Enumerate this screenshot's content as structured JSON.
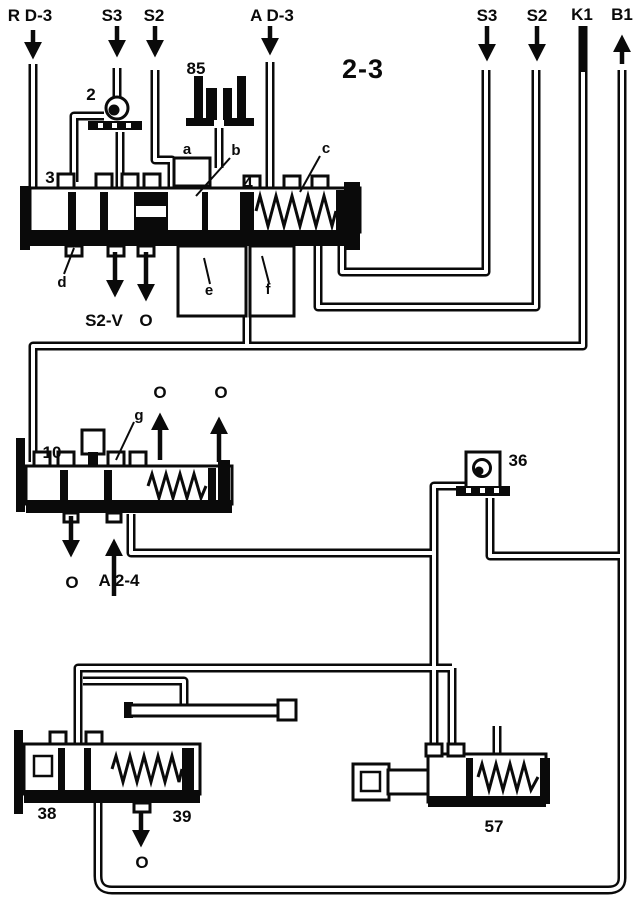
{
  "title": "2-3",
  "top_ports": {
    "rd3": "R D-3",
    "s3_left": "S3",
    "s2_left": "S2",
    "ad3": "A D-3",
    "s3_right": "S3",
    "s2_right": "S2",
    "k1": "K1",
    "b1": "B1"
  },
  "part_numbers": {
    "check_valve_upper": "2",
    "land_3": "3",
    "land_4": "4",
    "solenoid_85": "85",
    "valve_10": "10",
    "check_valve_36": "36",
    "valve_38": "38",
    "valve_39": "39",
    "valve_57": "57"
  },
  "callouts": {
    "a": "a",
    "b": "b",
    "c": "c",
    "d": "d",
    "e": "e",
    "f": "f",
    "g": "g"
  },
  "flow_labels": {
    "s2v": "S2-V",
    "o_upper_valve": "O",
    "o_valve10_top_left": "O",
    "o_valve10_top_right": "O",
    "o_valve10_bottom": "O",
    "a24": "A 2-4",
    "o_valve38": "O"
  },
  "colors": {
    "ink": "#0a0a0a",
    "paper": "#ffffff"
  }
}
